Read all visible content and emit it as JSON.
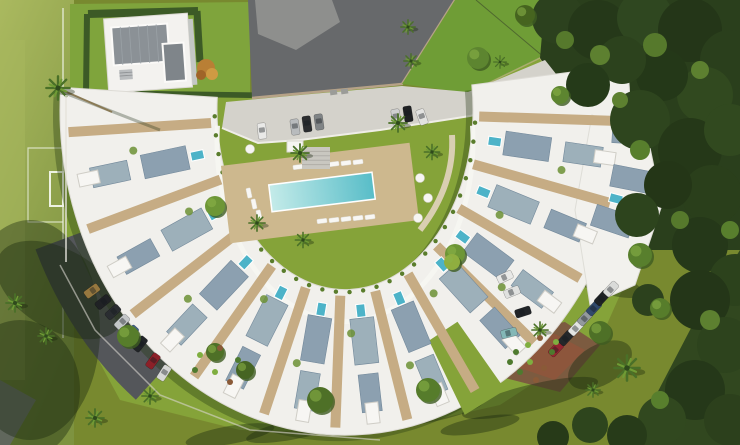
{
  "image": {
    "width": 740,
    "height": 445,
    "kind": "3d-architectural-aerial-render",
    "description": "Bird's-eye 3D render of a crescent-shaped white apartment complex with rooftop terraces and plunge pools, central communal swimming pool on a lawn courtyard, parking areas with cars, a football field on the left, a private villa top-left and dense woodland on the right"
  },
  "visible_text": [],
  "palette": {
    "lawn_olive": "#78892f",
    "lawn_bright": "#85a339",
    "field_green": "#9db055",
    "building_white": "#f1f0ec",
    "roof_panel": "#8ca0b0",
    "deck_tan": "#c6ac84",
    "pool_blue": "#58bdc8",
    "jacuzzi_blue": "#4db3c8",
    "pavement_dark": "#67696b",
    "concrete_light": "#d4d2cb",
    "asphalt": "#54565a",
    "woods_dark": "#2a3f1c",
    "hedge": "#3c5a26"
  },
  "scene": {
    "band": {
      "cx": 345,
      "cy": 110,
      "rxi": 128,
      "ryi": 180,
      "rxo": 285,
      "ryo": 325
    },
    "spokes": [
      176,
      158,
      140,
      123,
      107,
      92,
      77,
      62,
      47,
      32,
      17,
      2
    ],
    "bays": [
      167,
      149,
      131,
      115,
      99,
      84,
      69,
      50,
      39,
      24,
      9
    ],
    "gaps": [
      {
        "a1": 57,
        "a2": 66,
        "t1": 0.5,
        "t2": 1.06
      }
    ],
    "panels_extra": [
      {
        "phi": 12,
        "t": 1.05
      },
      {
        "phi": 20,
        "t": 1.0
      },
      {
        "phi": 4,
        "t": 1.02
      }
    ],
    "pools_extra": [
      {
        "phi": 16,
        "t": 0.98
      }
    ],
    "greens": [
      {
        "phi": 171,
        "t": 0.55
      },
      {
        "phi": 153,
        "t": 0.3
      },
      {
        "phi": 135,
        "t": 0.6
      },
      {
        "phi": 119,
        "t": 0.25
      },
      {
        "phi": 103,
        "t": 0.55
      },
      {
        "phi": 88,
        "t": 0.3
      },
      {
        "phi": 73,
        "t": 0.6
      },
      {
        "phi": 58,
        "t": 0.25
      },
      {
        "phi": 43,
        "t": 0.55
      },
      {
        "phi": 28,
        "t": 0.3
      },
      {
        "phi": 13,
        "t": 0.6
      }
    ],
    "courtyard": {
      "deck": {
        "x": 320,
        "y": 193,
        "w": 190,
        "h": 78,
        "rot": -7,
        "c": "#cdb88e"
      },
      "pool": {
        "x": 322,
        "y": 192,
        "w": 104,
        "h": 27,
        "rot": -7
      },
      "loungers": [
        [
          298,
          167,
          -7
        ],
        [
          310,
          166,
          -7
        ],
        [
          322,
          165,
          -7
        ],
        [
          334,
          164,
          -7
        ],
        [
          346,
          163,
          -7
        ],
        [
          358,
          162,
          -7
        ],
        [
          322,
          221,
          -7
        ],
        [
          334,
          220,
          -7
        ],
        [
          346,
          219,
          -7
        ],
        [
          358,
          218,
          -7
        ],
        [
          370,
          217,
          -7
        ],
        [
          249,
          193,
          78
        ],
        [
          254,
          204,
          78
        ],
        [
          259,
          215,
          78
        ]
      ],
      "stools": [
        [
          420,
          178
        ],
        [
          428,
          198
        ],
        [
          418,
          218
        ],
        [
          250,
          149
        ]
      ],
      "steps": {
        "x": 302,
        "y": 147,
        "w": 28,
        "h": 22
      },
      "awning": {
        "x": 287,
        "y": 141,
        "w": 16,
        "h": 11
      }
    },
    "cars": [
      {
        "x": 262,
        "y": 131,
        "rot": 84,
        "c": "#e9e9e7"
      },
      {
        "x": 295,
        "y": 127,
        "rot": 82,
        "c": "#b8bbbd"
      },
      {
        "x": 307,
        "y": 124,
        "rot": 82,
        "c": "#2b2d2f"
      },
      {
        "x": 319,
        "y": 122,
        "rot": 82,
        "c": "#808486"
      },
      {
        "x": 396,
        "y": 117,
        "rot": 81,
        "c": "#cfd0d0"
      },
      {
        "x": 408,
        "y": 114,
        "rot": 81,
        "c": "#1f2123"
      },
      {
        "x": 422,
        "y": 117,
        "rot": 70,
        "c": "#e2e2e0"
      },
      {
        "x": 92,
        "y": 291,
        "rot": 144,
        "c": "#97783f"
      },
      {
        "x": 103,
        "y": 302,
        "rot": 141,
        "c": "#202225"
      },
      {
        "x": 113,
        "y": 312,
        "rot": 138,
        "c": "#2a2d31"
      },
      {
        "x": 122,
        "y": 322,
        "rot": 135,
        "c": "#c3c6c8"
      },
      {
        "x": 131,
        "y": 333,
        "rot": 132,
        "c": "#3f608a"
      },
      {
        "x": 140,
        "y": 344,
        "rot": 129,
        "c": "#212427"
      },
      {
        "x": 153,
        "y": 361,
        "rot": 126,
        "c": "#8c2028"
      },
      {
        "x": 164,
        "y": 373,
        "rot": 123,
        "c": "#d6d7d5"
      },
      {
        "x": 556,
        "y": 349,
        "rot": -47,
        "c": "#962531"
      },
      {
        "x": 566,
        "y": 338,
        "rot": -47,
        "c": "#24272a"
      },
      {
        "x": 576,
        "y": 328,
        "rot": -47,
        "c": "#e3e4e2"
      },
      {
        "x": 585,
        "y": 318,
        "rot": -47,
        "c": "#93999d"
      },
      {
        "x": 594,
        "y": 308,
        "rot": -47,
        "c": "#31496b"
      },
      {
        "x": 602,
        "y": 298,
        "rot": -47,
        "c": "#1f2225"
      },
      {
        "x": 611,
        "y": 289,
        "rot": -47,
        "c": "#dadbd9"
      },
      {
        "x": 505,
        "y": 277,
        "rot": -25,
        "c": "#e8e8e6"
      },
      {
        "x": 512,
        "y": 292,
        "rot": -22,
        "c": "#e0e1df"
      },
      {
        "x": 523,
        "y": 312,
        "rot": -18,
        "c": "#212427"
      },
      {
        "x": 509,
        "y": 333,
        "rot": -14,
        "c": "#83b7b6"
      }
    ],
    "palms": [
      [
        58,
        88,
        1.3
      ],
      [
        15,
        303,
        1.0
      ],
      [
        46,
        336,
        0.9
      ],
      [
        300,
        153,
        1.0
      ],
      [
        398,
        123,
        1.0
      ],
      [
        257,
        223,
        0.9
      ],
      [
        303,
        240,
        0.85
      ],
      [
        432,
        152,
        0.85
      ],
      [
        627,
        368,
        1.4
      ],
      [
        408,
        27,
        0.8
      ],
      [
        411,
        61,
        0.8
      ],
      [
        500,
        62,
        0.7
      ],
      [
        95,
        418,
        1.0
      ],
      [
        150,
        396,
        0.9
      ],
      [
        540,
        330,
        0.9
      ],
      [
        593,
        390,
        0.8
      ]
    ],
    "round_trees": [
      [
        128,
        336,
        11,
        "#577d2b"
      ],
      [
        215,
        206,
        10,
        "#6d9636"
      ],
      [
        455,
        254,
        10,
        "#6d9636"
      ],
      [
        320,
        400,
        13,
        "#4e7027"
      ],
      [
        428,
        390,
        12,
        "#567c2b"
      ],
      [
        478,
        58,
        11,
        "#5d8530"
      ],
      [
        640,
        255,
        12,
        "#587f2d"
      ],
      [
        600,
        332,
        11,
        "#4e7027"
      ],
      [
        660,
        308,
        10,
        "#577d2b"
      ],
      [
        452,
        262,
        8,
        "#8fae3f"
      ],
      [
        215,
        352,
        9,
        "#4e7027"
      ],
      [
        245,
        370,
        9,
        "#466523"
      ],
      [
        560,
        95,
        9,
        "#5d8530"
      ],
      [
        525,
        15,
        10,
        "#46641f"
      ]
    ],
    "woods": [
      [
        558,
        18,
        26,
        "#2c411e"
      ],
      [
        598,
        30,
        30,
        "#253819"
      ],
      [
        645,
        18,
        28,
        "#2f4720"
      ],
      [
        690,
        30,
        32,
        "#243618"
      ],
      [
        730,
        60,
        30,
        "#2a3f1c"
      ],
      [
        705,
        95,
        28,
        "#31491f"
      ],
      [
        662,
        75,
        26,
        "#243818"
      ],
      [
        622,
        60,
        24,
        "#2c421d"
      ],
      [
        588,
        85,
        22,
        "#253a19"
      ],
      [
        640,
        120,
        30,
        "#2e451e"
      ],
      [
        690,
        150,
        32,
        "#253818"
      ],
      [
        730,
        130,
        26,
        "#31491f"
      ],
      [
        712,
        195,
        30,
        "#2a3f1b"
      ],
      [
        668,
        185,
        24,
        "#243617"
      ],
      [
        637,
        215,
        22,
        "#2d441d"
      ],
      [
        700,
        245,
        28,
        "#253819"
      ],
      [
        735,
        280,
        26,
        "#2c421c"
      ],
      [
        700,
        300,
        30,
        "#243618"
      ],
      [
        725,
        345,
        28,
        "#2d431d"
      ],
      [
        695,
        390,
        30,
        "#253819"
      ],
      [
        730,
        420,
        26,
        "#2c401c"
      ],
      [
        662,
        420,
        24,
        "#31481f"
      ],
      [
        627,
        435,
        20,
        "#273b19"
      ],
      [
        590,
        425,
        18,
        "#2e451d"
      ],
      [
        553,
        437,
        16,
        "#273a18"
      ],
      [
        648,
        300,
        16,
        "#2c411d"
      ],
      [
        600,
        55,
        10,
        "#5d8030"
      ],
      [
        655,
        45,
        12,
        "#56792c"
      ],
      [
        700,
        70,
        9,
        "#5d8030"
      ],
      [
        640,
        150,
        10,
        "#587f2d"
      ],
      [
        680,
        220,
        9,
        "#56792c"
      ],
      [
        710,
        320,
        10,
        "#5d8030"
      ],
      [
        660,
        400,
        9,
        "#587f2d"
      ],
      [
        565,
        40,
        9,
        "#56792c"
      ],
      [
        620,
        100,
        8,
        "#5d8030"
      ],
      [
        730,
        230,
        9,
        "#587f2d"
      ]
    ],
    "shadow_streaks": [
      [
        300,
        428,
        55,
        10,
        -12
      ],
      [
        420,
        412,
        65,
        12,
        -10
      ],
      [
        530,
        398,
        70,
        13,
        -14
      ],
      [
        230,
        435,
        45,
        9,
        -10
      ],
      [
        350,
        400,
        30,
        7,
        -12
      ],
      [
        600,
        365,
        35,
        20,
        -30
      ],
      [
        480,
        425,
        40,
        8,
        -10
      ],
      [
        605,
        120,
        45,
        10,
        15
      ],
      [
        610,
        200,
        40,
        10,
        10
      ],
      [
        600,
        280,
        45,
        12,
        18
      ],
      [
        30,
        330,
        70,
        110,
        0
      ],
      [
        60,
        290,
        70,
        40,
        30
      ],
      [
        20,
        390,
        60,
        70,
        0
      ]
    ],
    "bed_plants": [
      [
        516,
        352
      ],
      [
        528,
        345
      ],
      [
        540,
        338
      ],
      [
        552,
        352
      ],
      [
        530,
        362
      ],
      [
        544,
        368
      ],
      [
        520,
        372
      ],
      [
        556,
        342
      ],
      [
        536,
        380
      ],
      [
        510,
        362
      ],
      [
        200,
        355
      ],
      [
        220,
        348
      ],
      [
        238,
        360
      ],
      [
        215,
        372
      ],
      [
        230,
        382
      ],
      [
        195,
        370
      ]
    ]
  }
}
